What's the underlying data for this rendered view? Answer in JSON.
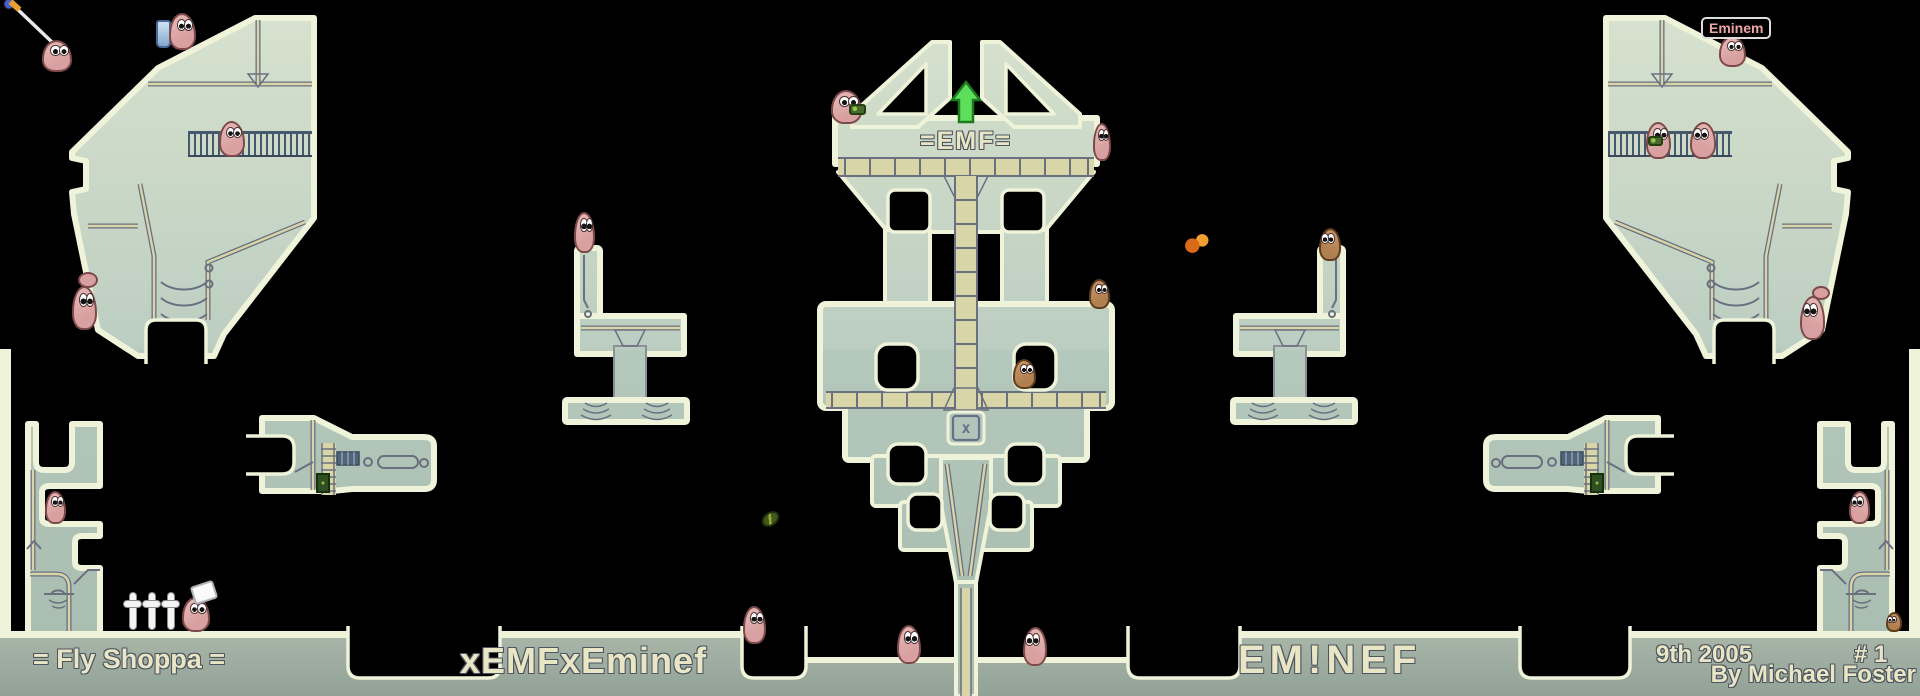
{
  "map": {
    "emf_banner": "=EMF=",
    "x_box_symbol": "x"
  },
  "floor_texts": {
    "map_title": "= Fly Shoppa =",
    "team_left": "xEMFxEminef",
    "team_right": "EM!NEF",
    "date": "9th 2005",
    "number": "# 1",
    "credit": "By Michael Foster"
  },
  "labels": {
    "worm_name": "Eminem"
  },
  "colors": {
    "background": "#000000",
    "terrain_edge": "#eef3d9",
    "terrain_light": "#d8e2cf",
    "terrain_deep": "#aec3b7",
    "seam_tan": "#d8d5a8",
    "seam_gray": "#6a7080",
    "floor_top": "#aab7aa",
    "floor_bottom": "#92a296",
    "railing": "#46586c",
    "worm_pink": "#d8a0a0",
    "worm_outline": "#7c4a4a",
    "worm_brown": "#b08050",
    "arrow_green": "#5ce05c",
    "text_cream": "#e9e6c6",
    "text_outline": "#4e5560",
    "label_pink": "#eaa6a6"
  },
  "entities": [
    {
      "name": "rope-worm",
      "kind": "worm",
      "x": 42,
      "y": 40,
      "w": 30,
      "h": 32
    },
    {
      "name": "jetpack",
      "kind": "jetpack",
      "x": 156,
      "y": 20,
      "w": 15,
      "h": 28,
      "interactable": false
    },
    {
      "name": "jetpack-worm",
      "kind": "worm",
      "x": 169,
      "y": 13,
      "w": 27,
      "h": 37
    },
    {
      "name": "caged-worm-left",
      "kind": "worm",
      "x": 219,
      "y": 121,
      "w": 26,
      "h": 36
    },
    {
      "name": "ledge-worm-tail-left",
      "kind": "blob",
      "x": 78,
      "y": 272,
      "w": 20,
      "h": 16,
      "interactable": false
    },
    {
      "name": "ledge-worm-left",
      "kind": "worm",
      "x": 72,
      "y": 286,
      "w": 25,
      "h": 44
    },
    {
      "name": "post-worm-left",
      "kind": "worm",
      "x": 574,
      "y": 212,
      "w": 21,
      "h": 41
    },
    {
      "name": "tower-worm-armed",
      "kind": "worm",
      "x": 831,
      "y": 90,
      "w": 31,
      "h": 34
    },
    {
      "name": "bazooka-green",
      "kind": "gear",
      "x": 849,
      "y": 104,
      "w": 17,
      "h": 11,
      "interactable": false
    },
    {
      "name": "tower-worm-edge",
      "kind": "worm",
      "x": 1093,
      "y": 123,
      "w": 18,
      "h": 38
    },
    {
      "name": "flame",
      "kind": "flame",
      "x": 1184,
      "y": 232,
      "w": 26,
      "h": 22,
      "interactable": false
    },
    {
      "name": "post-worm-right",
      "kind": "worm",
      "cls": "c-brown f-left",
      "x": 1319,
      "y": 228,
      "w": 22,
      "h": 33
    },
    {
      "name": "tier-worm-brown",
      "kind": "worm",
      "cls": "c-brown",
      "x": 1089,
      "y": 279,
      "w": 21,
      "h": 30
    },
    {
      "name": "notch-worm-brown",
      "kind": "worm",
      "cls": "c-brown",
      "x": 1013,
      "y": 359,
      "w": 23,
      "h": 30
    },
    {
      "name": "stray-grenade",
      "kind": "grenade",
      "x": 761,
      "y": 512,
      "w": 19,
      "h": 14,
      "interactable": false
    },
    {
      "name": "floor-worm-left",
      "kind": "worm",
      "x": 743,
      "y": 606,
      "w": 23,
      "h": 38
    },
    {
      "name": "floor-worm-center-left",
      "kind": "worm",
      "x": 897,
      "y": 625,
      "w": 24,
      "h": 39
    },
    {
      "name": "floor-worm-center-right",
      "kind": "worm",
      "cls": "f-left",
      "x": 1023,
      "y": 627,
      "w": 24,
      "h": 39
    },
    {
      "name": "pocket-worm-left",
      "kind": "worm",
      "x": 45,
      "y": 491,
      "w": 21,
      "h": 33
    },
    {
      "name": "gravestone-1",
      "kind": "grave",
      "x": 123,
      "y": 592,
      "w": 19,
      "h": 38,
      "interactable": false
    },
    {
      "name": "gravestone-2",
      "kind": "grave",
      "x": 142,
      "y": 592,
      "w": 19,
      "h": 38,
      "interactable": false
    },
    {
      "name": "gravestone-3",
      "kind": "grave",
      "x": 161,
      "y": 592,
      "w": 19,
      "h": 38,
      "interactable": false
    },
    {
      "name": "flag-worm",
      "kind": "worm",
      "x": 182,
      "y": 597,
      "w": 28,
      "h": 35
    },
    {
      "name": "flag-worm-hat",
      "kind": "hat",
      "x": 192,
      "y": 583,
      "w": 24,
      "h": 19,
      "interactable": false
    },
    {
      "name": "eminem-worm",
      "kind": "worm",
      "x": 1719,
      "y": 36,
      "w": 27,
      "h": 31
    },
    {
      "name": "caged-worm-right-armed",
      "kind": "worm",
      "x": 1646,
      "y": 122,
      "w": 25,
      "h": 37
    },
    {
      "name": "caged-gear",
      "kind": "gear",
      "x": 1648,
      "y": 136,
      "w": 15,
      "h": 10,
      "interactable": false
    },
    {
      "name": "caged-worm-right",
      "kind": "worm",
      "cls": "f-left",
      "x": 1690,
      "y": 122,
      "w": 26,
      "h": 37
    },
    {
      "name": "ledge-worm-right-tail",
      "kind": "blob",
      "x": 1812,
      "y": 286,
      "w": 18,
      "h": 14,
      "interactable": false
    },
    {
      "name": "ledge-worm-right",
      "kind": "worm",
      "cls": "f-left",
      "x": 1800,
      "y": 296,
      "w": 25,
      "h": 44
    },
    {
      "name": "pocket-worm-right",
      "kind": "worm",
      "cls": "f-left",
      "x": 1849,
      "y": 491,
      "w": 21,
      "h": 33
    },
    {
      "name": "corner-worm",
      "kind": "worm",
      "cls": "c-brown f-left",
      "x": 1886,
      "y": 612,
      "w": 16,
      "h": 20
    }
  ]
}
